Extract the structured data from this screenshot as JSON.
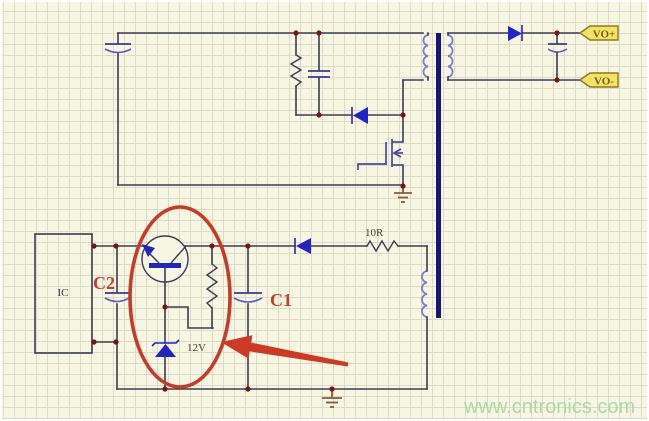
{
  "diagram": {
    "type": "flyback-converter-schematic",
    "labels": {
      "ic": "IC",
      "c2": "C2",
      "c1": "C1",
      "zener_voltage": "12V",
      "snubber_resistor_value": "10R",
      "output_positive": "VO+",
      "output_negative": "VO-"
    },
    "watermark": "www.cntronics.com",
    "annotations": {
      "highlight_ellipse": "red ellipse around transistor and 12V zener branch",
      "pointer_arrow": "red arrow pointing at highlighted branch"
    },
    "colors": {
      "background": "#f7f6e3",
      "grid": "#dcdbc5",
      "wire": "#3b3b55",
      "component_blue": "#2323c8",
      "winding_blue": "#7b7bd0",
      "core_blue": "#16167a",
      "junction_dot": "#701818",
      "ground_brown": "#8a5a3a",
      "annotation_red": "#c93a28",
      "tag_fill": "#f2e368",
      "tag_text": "#7a5c10",
      "watermark_green": "#afd8a8"
    }
  }
}
